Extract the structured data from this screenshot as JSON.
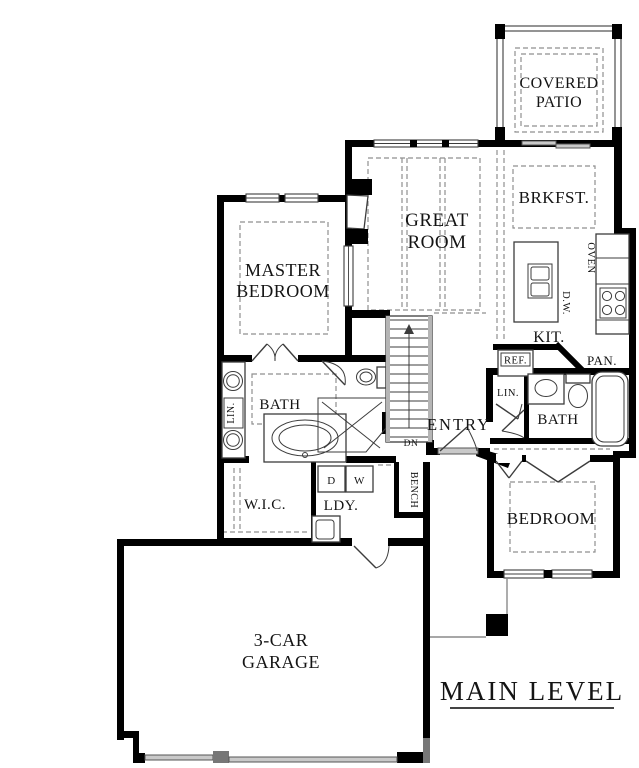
{
  "title": "MAIN LEVEL",
  "colors": {
    "background": "#ffffff",
    "walls": "#000000",
    "fixture_line": "#3c3c3c",
    "dashed_line": "#8f8f8f",
    "door_window": "#c9c9c9",
    "text": "#141414"
  },
  "rooms": {
    "covered_patio": {
      "line1": "COVERED",
      "line2": "PATIO"
    },
    "great_room": {
      "line1": "GREAT",
      "line2": "ROOM"
    },
    "brkfst": {
      "label": "BRKFST."
    },
    "master_bedroom": {
      "line1": "MASTER",
      "line2": "BEDROOM"
    },
    "kitchen": {
      "label": "KIT."
    },
    "master_bath": {
      "label": "BATH"
    },
    "bath_2": {
      "label": "BATH"
    },
    "entry": {
      "label": "ENTRY"
    },
    "wic": {
      "label": "W.I.C."
    },
    "laundry": {
      "label": "LDY."
    },
    "bedroom_2": {
      "label": "BEDROOM"
    },
    "garage": {
      "line1": "3-CAR",
      "line2": "GARAGE"
    }
  },
  "fixtures": {
    "oven": "OVEN",
    "dishwasher": "D.W.",
    "refrigerator": "REF.",
    "pantry": "PAN.",
    "linen_master": "LIN.",
    "linen_hall": "LIN.",
    "dryer": "D",
    "washer": "W",
    "bench": "BENCH",
    "stairs_down": "DN"
  }
}
